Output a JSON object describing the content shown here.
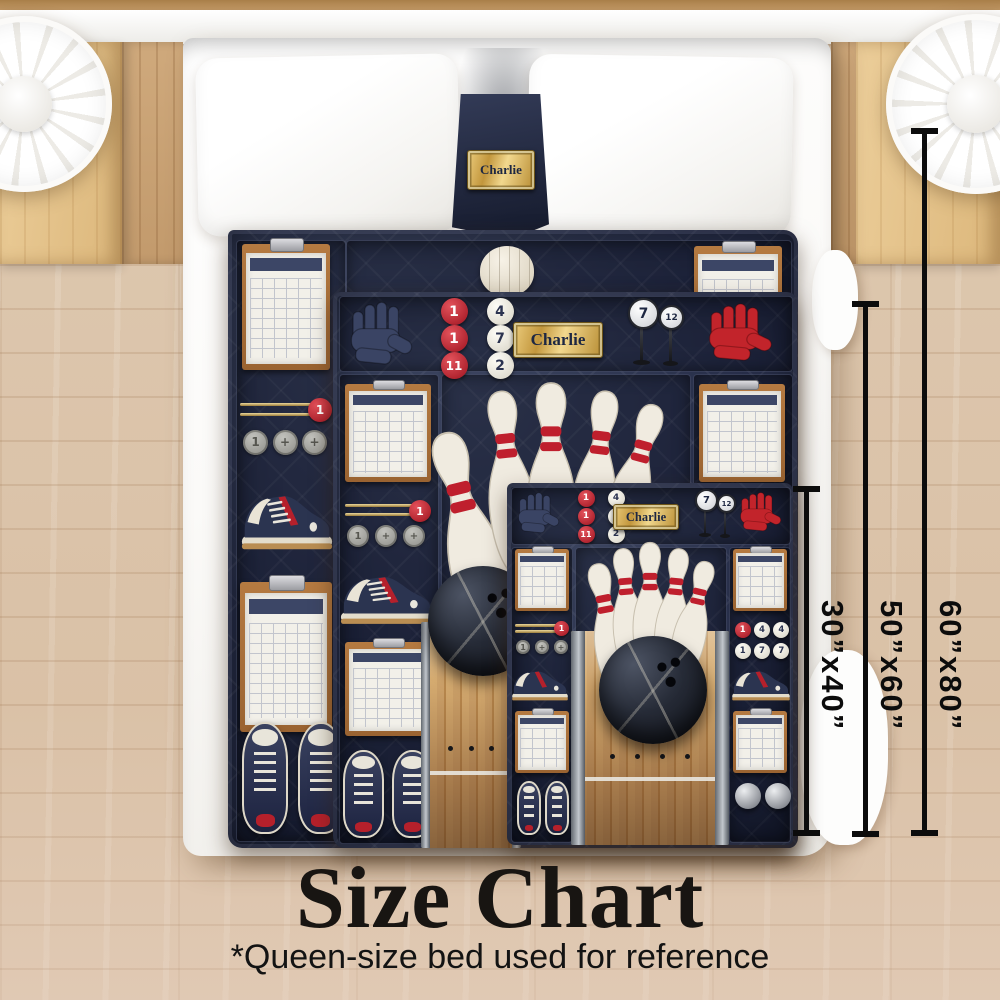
{
  "page": {
    "title": "Size Chart",
    "note": "*Queen-size bed used for reference"
  },
  "personalization": {
    "name": "Charlie"
  },
  "size_options": [
    {
      "label": "30”x40”"
    },
    {
      "label": "50”x60”"
    },
    {
      "label": "60”x80”"
    }
  ],
  "quilt_design": {
    "theme": "bowling",
    "plaque_text": "Charlie",
    "header_buttons": [
      "1",
      "4",
      "1",
      "7",
      "11",
      "2"
    ],
    "pin_markers": [
      "7",
      "12"
    ],
    "score_buttons": [
      "1",
      "4",
      "4",
      "1",
      "7",
      "7"
    ],
    "coin_labels": [
      "1",
      "+",
      "+"
    ],
    "rack_ball_label": "1"
  },
  "colors": {
    "quilt_navy": "#272e49",
    "accent_red": "#c2242b",
    "plaque_gold": "#c9a24a",
    "pin_cream": "#f0ebe0",
    "lane_wood": "#c49a60",
    "ball_black": "#14161c",
    "floor_wood": "#ddc7ae",
    "dimension_line": "#0c0c0c"
  }
}
